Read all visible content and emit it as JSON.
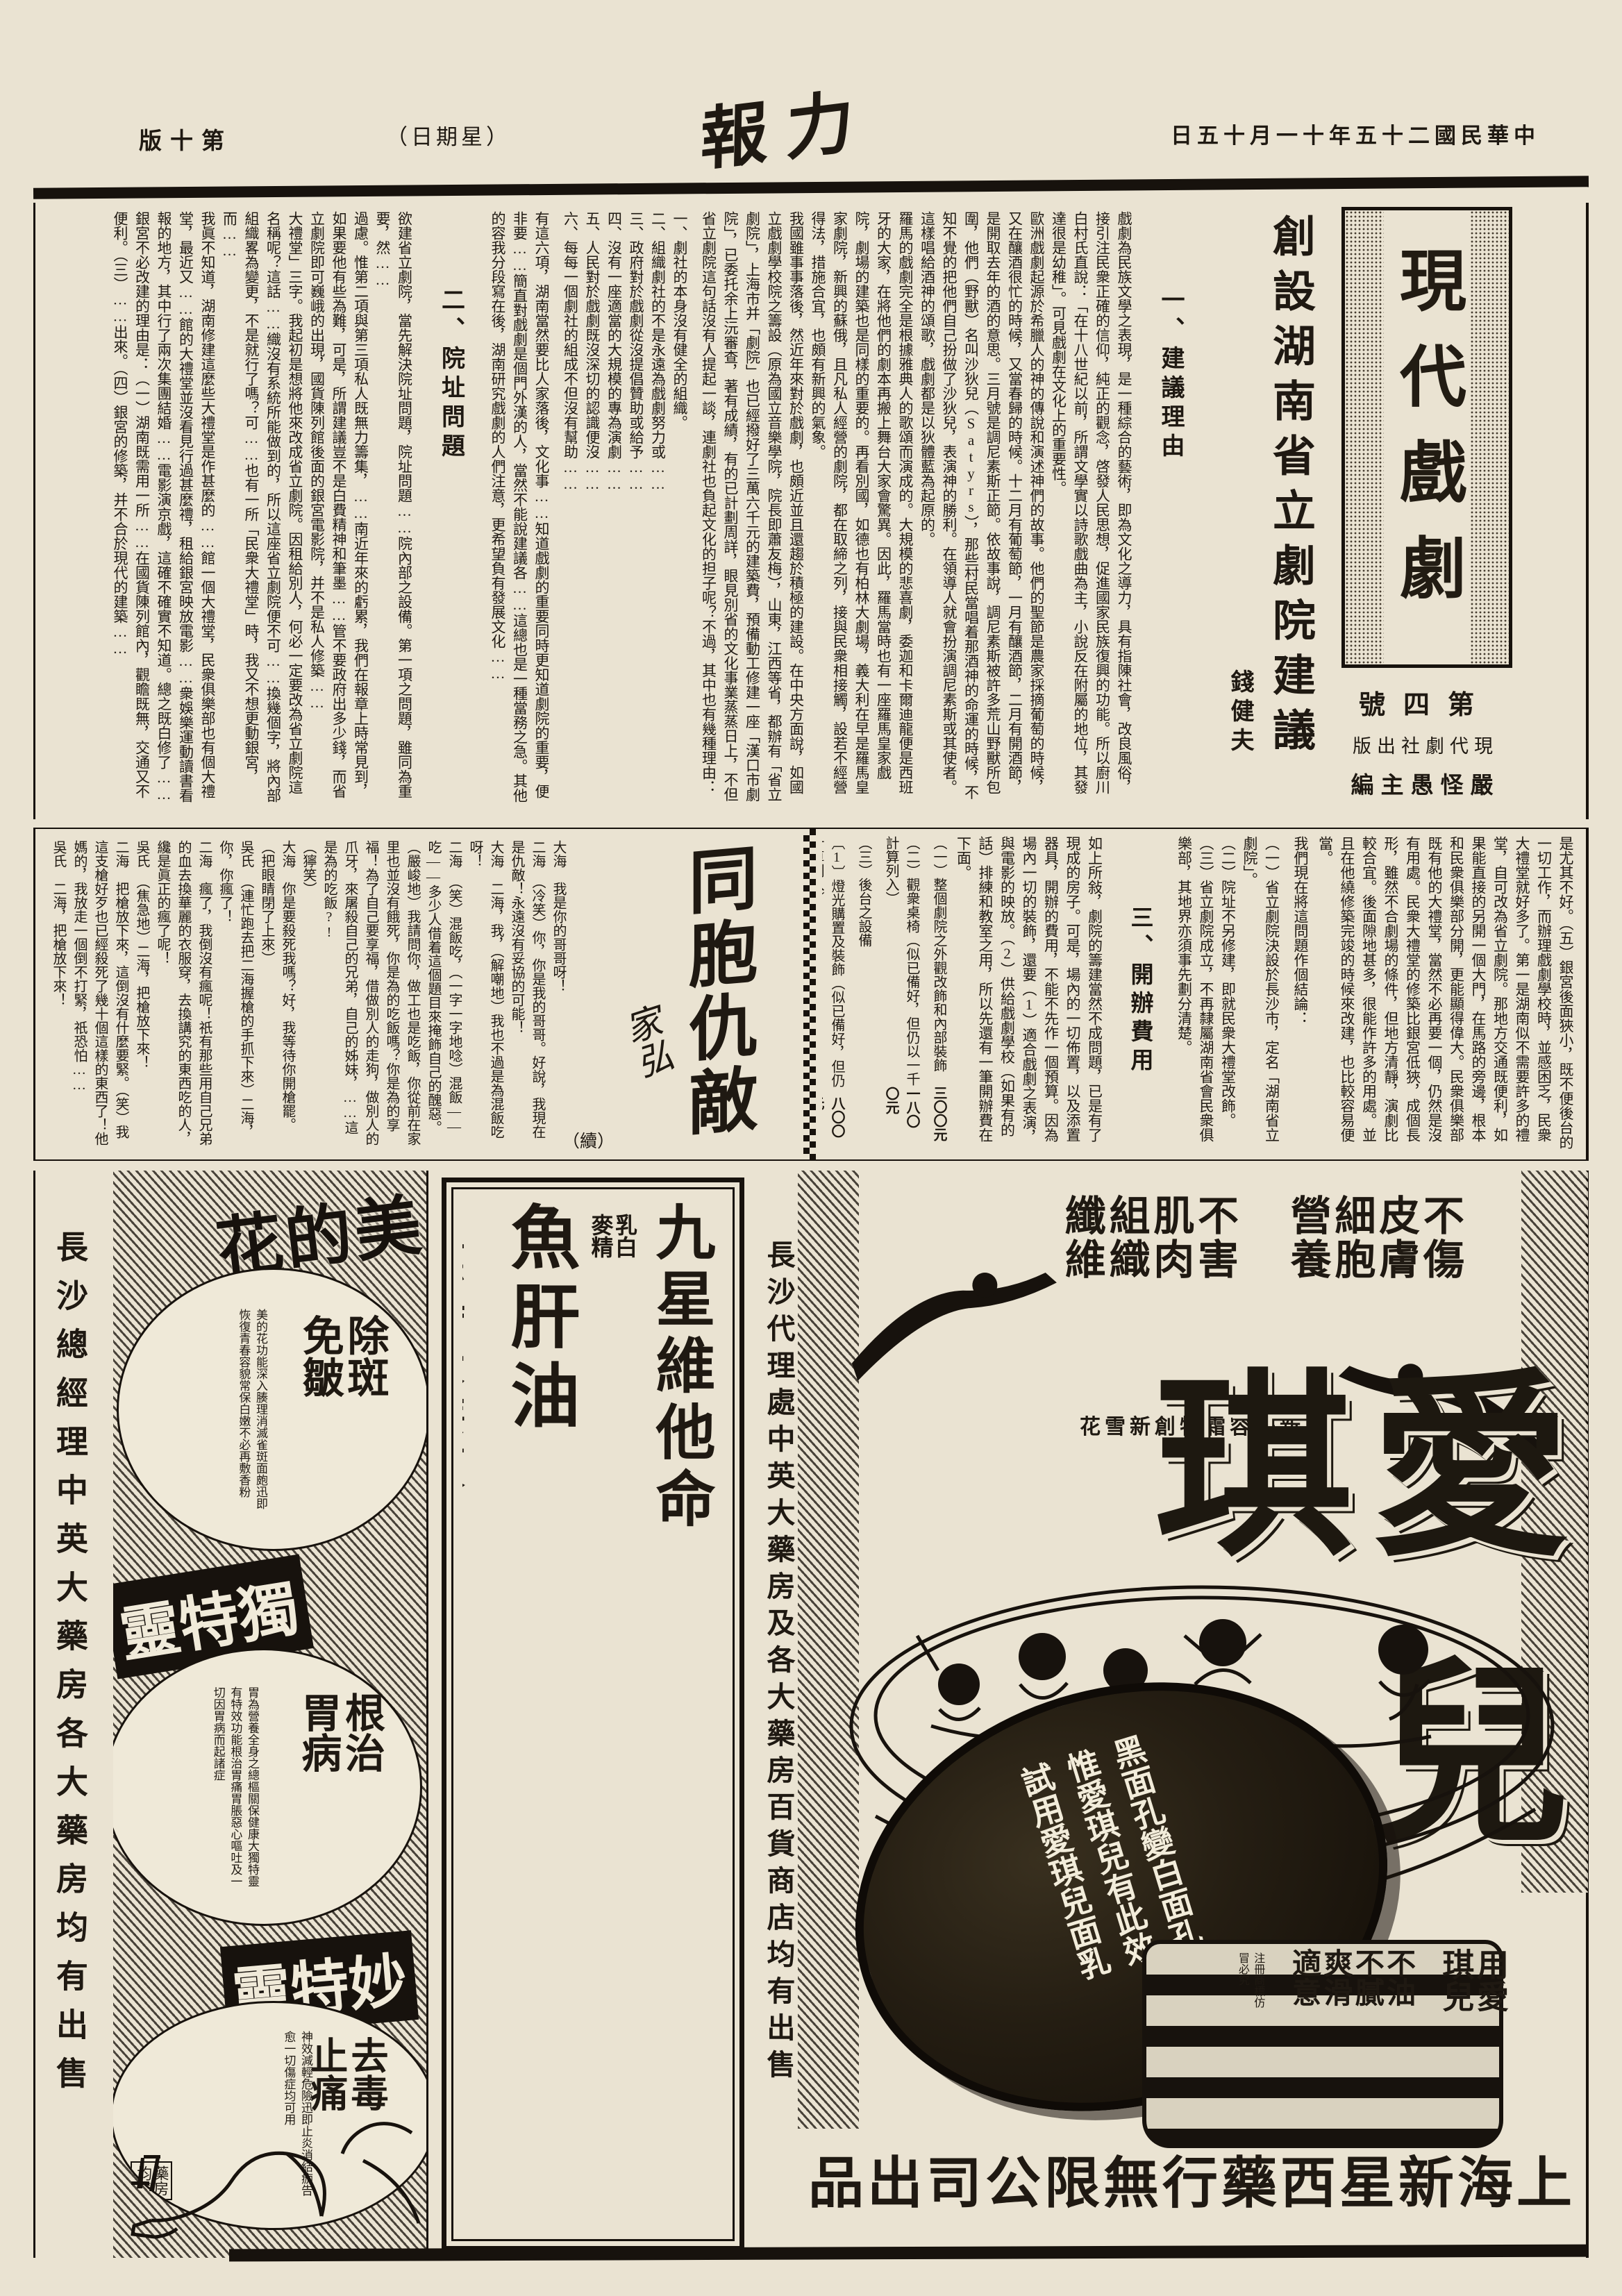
{
  "masthead": {
    "date": "中華民國二十五年十一月十五日",
    "title": "力報",
    "weekday": "（星期日）",
    "edition": "第十版"
  },
  "article": {
    "headline": "創設湖南省立劇院建議",
    "author": "錢健夫",
    "supplement": {
      "logo": "現代戲劇",
      "issue": "第四號",
      "publisher": "現代劇社出版",
      "editor": "嚴怪愚主編"
    },
    "s1_heading": "一、建議理由",
    "s1_paras": [
      "戲劇為民族文學之表現，是一種綜合的藝術，即為文化之導力，具有指陳社會，改良風俗，接引注民衆正確的信仰，純正的觀念，啓發人民思想，促進國家民族復興的功能。所以廚川白村氏直說：「在十八世紀以前，所謂文學實以詩歌戲曲為主，小說反在附屬的地位，其發達很是幼稚」。可見戲劇在文化上的重要性。",
      "歐洲戲劇起源於希臘人的神的傳說和演述神們的故事。他們的聖節是農家採摘葡萄的時候，又在釀酒很忙的時候，又當春歸的時候。十二月有葡萄節，一月有釀酒節，二月有開酒節，是開取去年的酒的意思。三月號是調尼素斯正節。依故事說，調尼素斯被許多荒山野獸所包圍，他們（野獸）名叫沙狄兒（Satyrs），那些村民當唱着那酒神的命運的時候，不知不覺的把他們自己扮做了沙狄兒，表演神的勝利。在領導人就會扮演調尼素斯或其使者。這樣唱給酒神的頌歌，戲劇都是以狄體藍為起原的。",
      "羅馬的戲劇完全是根據雅典人的歌頌而演成的。大規模的悲喜劇，委迦和卡爾迪龍便是西班牙的大家，在將他們的劇本再搬上舞台大家會驚異。因此，羅馬當時也有一座羅馬皇家戲院，劇場的建築也是同樣的重要的。再看別國，如德也有柏林大劇場，義大利在早是羅馬皇家劇院，新興的蘇俄，且凡私人經營的劇院，都在取締之列，接與民衆相接觸，設若不經營得法，措施合宜，也頗有新興的氣象。",
      "我國雖事事落後，然近年來對於戲劇，也頗近並且還趨於積極的建設。在中央方面說，如國立戲劇學校院之籌設（原為國立音樂學院，院長即蕭友梅），山東，江西等省，都辦有「省立劇院」，上海市并「劇院」也已經撥好了三萬六千元的建築費，預備動工修建一座「漢口市劇院」，已委托余上沅審查，著有成績，有的已計劃周詳，眼見別省的文化事業蒸蒸日上，不但省立劇院這句話沒有人提起一談，連劇社也負起文化的担子呢？不過，其中也有幾種理由："
    ],
    "s1_reasons": [
      "一、劇社的本身沒有健全的組織。",
      "二、組織劇社的不是永遠為戲劇努力或……",
      "三、政府對於戲劇從沒提倡贊助或給予……",
      "四、沒有一座適當的大規模的專為演劇……",
      "五、人民對於戲劇既沒深切的認識便沒……",
      "六、每每一個劇社的組成不但沒有幫助……"
    ],
    "s1_close": "有這六項，湖南當然要比人家落後，文化事……知道戲劇的重要同時更知道劇院的重要，便非要……簡直對戲劇是個門外漢的人，當然不能說建議各……這總也是一種當務之急。其他的容我分段寫在後，湖南研究戲劇的人們注意，更希望負有發展文化……",
    "s2_heading": "二、院址問題",
    "s2_paras": [
      "欲建省立劇院，當先解決院址問題，院址問題……院內部之設備。第一項之問題，雖同為重要，然……",
      "過慮。惟第二項與第三項私人既無力籌集，……南近年來的虧累，我們在報章上時常見到，如果要他有些為難，可是，所謂建議豈不是白費精神和筆墨……管不要政府出多少錢，而省立劇院即可巍峨的出現，國貨陳列館後面的銀宮電影院，并不是私人修築……",
      "大禮堂」三字。我起初是想將他來改成省立劇院。因租給別人，何必一定要改為省立劇院這名稱呢？這話……織沒有系統所能做到的，所以這座省立劇院便不可……換幾個字，將內部組織畧為變更，不是就行了嗎？可……也有一所「民衆大禮堂」時，我又不想更動銀宮，而……",
      "我眞不知道，湖南修建這麼些大禮堂是作甚麼的……館一個大禮堂，民衆俱樂部也有個大禮堂，最近又……館的大禮堂並沒看見行過甚麼禮，租給銀宮映放電影……衆娛樂運動讀書看報的地方，其中行了兩次集團結婚……電影演京戲，這確不確實不知道。總之既白修了……",
      "銀宮不必改建的理由是：（一）湖南既需用一所……在國貨陳列館內，觀瞻既無，交通又不便利。（三）……出來。（四）銀宮的修築，并不合於現代的建築……"
    ],
    "s2_cont": "是尤其不好。（五）銀宮後面狹小，既不便後台的一切工作，而辦理戲劇學校時，並感困乏，民衆大禮堂就好多了。第一是湖南似不需要許多的禮堂，自可改為省立劇院。那地方交通既便利，如果能直接的另開一個大門，在馬路的旁邊，根本和民衆俱樂部分開，更能顯得偉大。民衆俱樂部既有他的大禮堂，當然不必再要一個，仍然是沒有用處。民衆大禮堂的修築比銀宮低狹，成個長形，雖然不合劇場的條件，但地方清靜，演劇比較合宜。後面隙地甚多，很能作許多的用處。並且在他繞修築完竣的時候來改建，也比較容易便當。",
    "s2_conclusion_intro": "我們現在將這問題作個結論：",
    "s2_conclusions": [
      "（一）省立劇院決設於長沙市，定名「湖南省立劇院」。",
      "（二）院址不另修建，即就民衆大禮堂改飾。",
      "（三）省立劇院成立，不再隸屬湖南省會民衆俱樂部，其地界亦須事先劃分清楚。"
    ],
    "s3_heading": "三、開辦費用",
    "s3_intro": "如上所敍，劇院的籌建當然不成問題，已是有了現成的房子。可是，場內的一切佈置，以及添置器具，開辦的費用，不能不先作一個預算。因為場內一切的裝飾，還要（1）適合戲劇之表演，與電影的映放。（2）供給戲劇學校（如果有的話）排練和教室之用，所以先還有一筆開辦費在下面。",
    "s3_items": [
      {
        "label": "（一）整個劇院之外觀改飾和內部裝飾",
        "amount": "三〇〇元"
      },
      {
        "label": "（二）觀衆桌椅（似已備好，但仍以一千計算列入）",
        "amount": "一八〇〇元"
      },
      {
        "label": "（三）後台之設備",
        "amount": ""
      },
      {
        "label": "〔1〕燈光購置及裝飾（似已備好，但仍計算列入）",
        "amount": "八〇〇元"
      },
      {
        "label": "〔2〕大幕",
        "amount": "二六〇元"
      },
      {
        "label": "〔3〕布條景",
        "amount": "一五〇元"
      },
      {
        "label": "〔4〕硬板景",
        "amount": "二〇〇元"
      },
      {
        "label": "〔5〕屏風景",
        "amount": "二四〇元"
      },
      {
        "label": "〔6〕節光機四個",
        "amount": "四〇〇元"
      },
      {
        "label": "（四）全台及全院傢具",
        "amount": "四〇〇元"
      },
      {
        "label": "（五）辦公室兩大間（案存劇院之外）",
        "amount": "二〇〇〇元"
      },
      {
        "label": "（六）開辦時雜項費用",
        "amount": "二〇〇元"
      }
    ],
    "s3_total_label": "合計",
    "s3_total": "四六八〇元",
    "s3_note": "（未完）"
  },
  "fiction": {
    "title": "同胞仇敵",
    "continuation": "（續）",
    "author": "家弘",
    "lines": [
      "大海　我是你的哥哥呀！",
      "二海　（冷笑）你，你是我的哥哥。好說，我現在是仇敵！永遠沒有妥協的可能！",
      "大海　二海，我，（解嘲地）我也不過是為混飯吃呀！",
      "二海　（笑）混飯吃，（一字一字地唸）混飯——吃——多少人借着這個題目來掩飾自己的醜惡。（嚴峻地）我請問你，做工也是吃飯，你從前在家里也並沒有餓死，你是為的吃飯嗎？你是為的享福！為了自己要享福，借做別人的走狗，做別人的爪牙，來屠殺自己的兄弟，自己的姊妹，……這是為的吃飯?!",
      "（獰笑）",
      "大海　你是要殺死我嗎？好，我等待你開槍罷。（把眼睛閉了上來）",
      "吳氏　（連忙跑去把二海握槍的手抓下來）二海，你，你瘋了！",
      "二海　瘋了，我倒沒有瘋呢！祇有那些用自己兄弟的血去換華麗的衣服穿，去換講究的東西吃的人，纔是眞正的瘋了呢！",
      "吳氏　（焦急地）二海，把槍放下來！",
      "二海　把槍放下來，這倒沒有什麼要緊。（笑）我這支槍好歹也已經殺死了幾十個這樣的東西了！他媽的，我放走一個倒不打緊，祇恐怕……",
      "吳氏　二海，把槍放下來！",
      "………………",
      "（未完）"
    ]
  },
  "ads": {
    "meidihua": {
      "agent": "長沙總經理中英大藥房各大藥房均有出售",
      "brand1": "美的花",
      "claim1": "除斑免皺",
      "detail1": "美的花功能深入腠理消滅雀斑面皰迅即恢復青春容貌常保白嫩不必再敷香粉",
      "brand2": "獨特靈",
      "claim2": "根治胃病",
      "detail2": "胃為營養全身之總樞關保健康大獨特靈有特效功能根治胃痛胃脹惡心嘔吐及一切因胃病而起諸症",
      "brand3": "妙特靈",
      "claim3": "去毒止痛",
      "detail3": "神效減輕危險迅即止炎消結痂告愈一切傷症均可用",
      "note3": "藥房均售"
    },
    "jiuxing": {
      "product": "九星維他命",
      "sub": "乳白麥精",
      "product2": "魚肝油",
      "promo": "應時大廉價",
      "promo_small": "照碼八折買二送一",
      "line": "各大藥房同時舉行",
      "signoff": "長沙經理處中西大藥房謹啟"
    },
    "aiqier": {
      "slogan1": "不傷皮膚細胞營養",
      "slogan2": "不害肌肉組織纖維",
      "subtitle": "新美容霜特創新雪花",
      "brand": "愛琪兒",
      "lid_lines": [
        "黑面孔變白面孔",
        "惟愛琪兒有此效",
        "試用愛琪兒面乳"
      ],
      "agent": "長沙代理處中英大藥房及各大藥房百貨商店均有出售",
      "usage": "用愛琪兒",
      "usage2": "不油不膩爽滑適意",
      "small_print": "注冊商標仿冒必究",
      "footer": "上海新星西藥行無限公司出品"
    }
  }
}
